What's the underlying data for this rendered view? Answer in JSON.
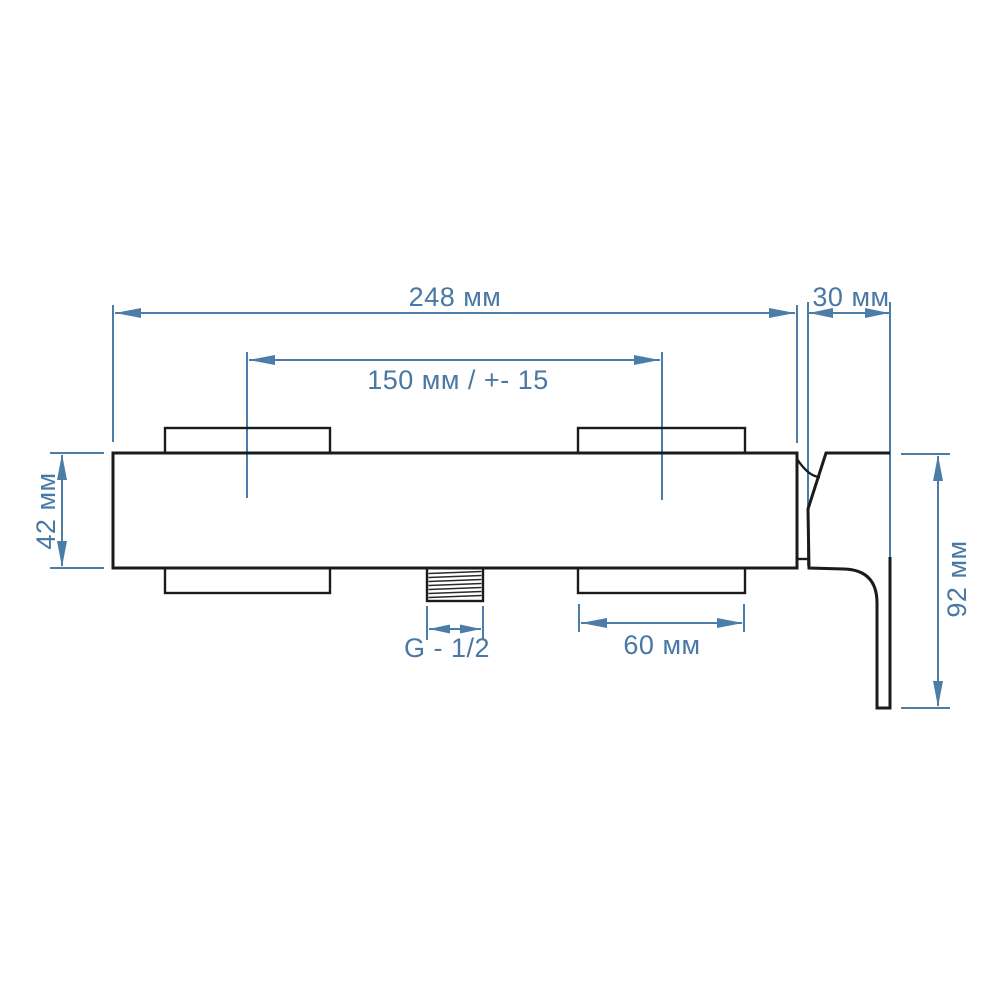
{
  "page": {
    "background_color": "#ffffff",
    "kind": "faucet-installation-dimension-drawing"
  },
  "drawing": {
    "accent_color": "#4b7da7",
    "outline_color": "#1b1b1b",
    "units": "мм",
    "dimensions": {
      "total_width": {
        "label": "248 мм",
        "value": 248,
        "unit": "мм"
      },
      "wall_offset": {
        "label": "30 мм",
        "value": 30,
        "unit": "мм"
      },
      "hole_spacing": {
        "label": "150 мм / +- 15",
        "value": 150,
        "tolerance": "+- 15",
        "unit": "мм"
      },
      "body_height": {
        "label": "42 мм",
        "value": 42,
        "unit": "мм"
      },
      "handle_drop": {
        "label": "92 мм",
        "value": 92,
        "unit": "мм"
      },
      "mount_block_width": {
        "label": "60 мм",
        "value": 60,
        "unit": "мм"
      },
      "outlet_thread": {
        "label": "G - 1/2",
        "value": "G - 1/2"
      }
    }
  }
}
